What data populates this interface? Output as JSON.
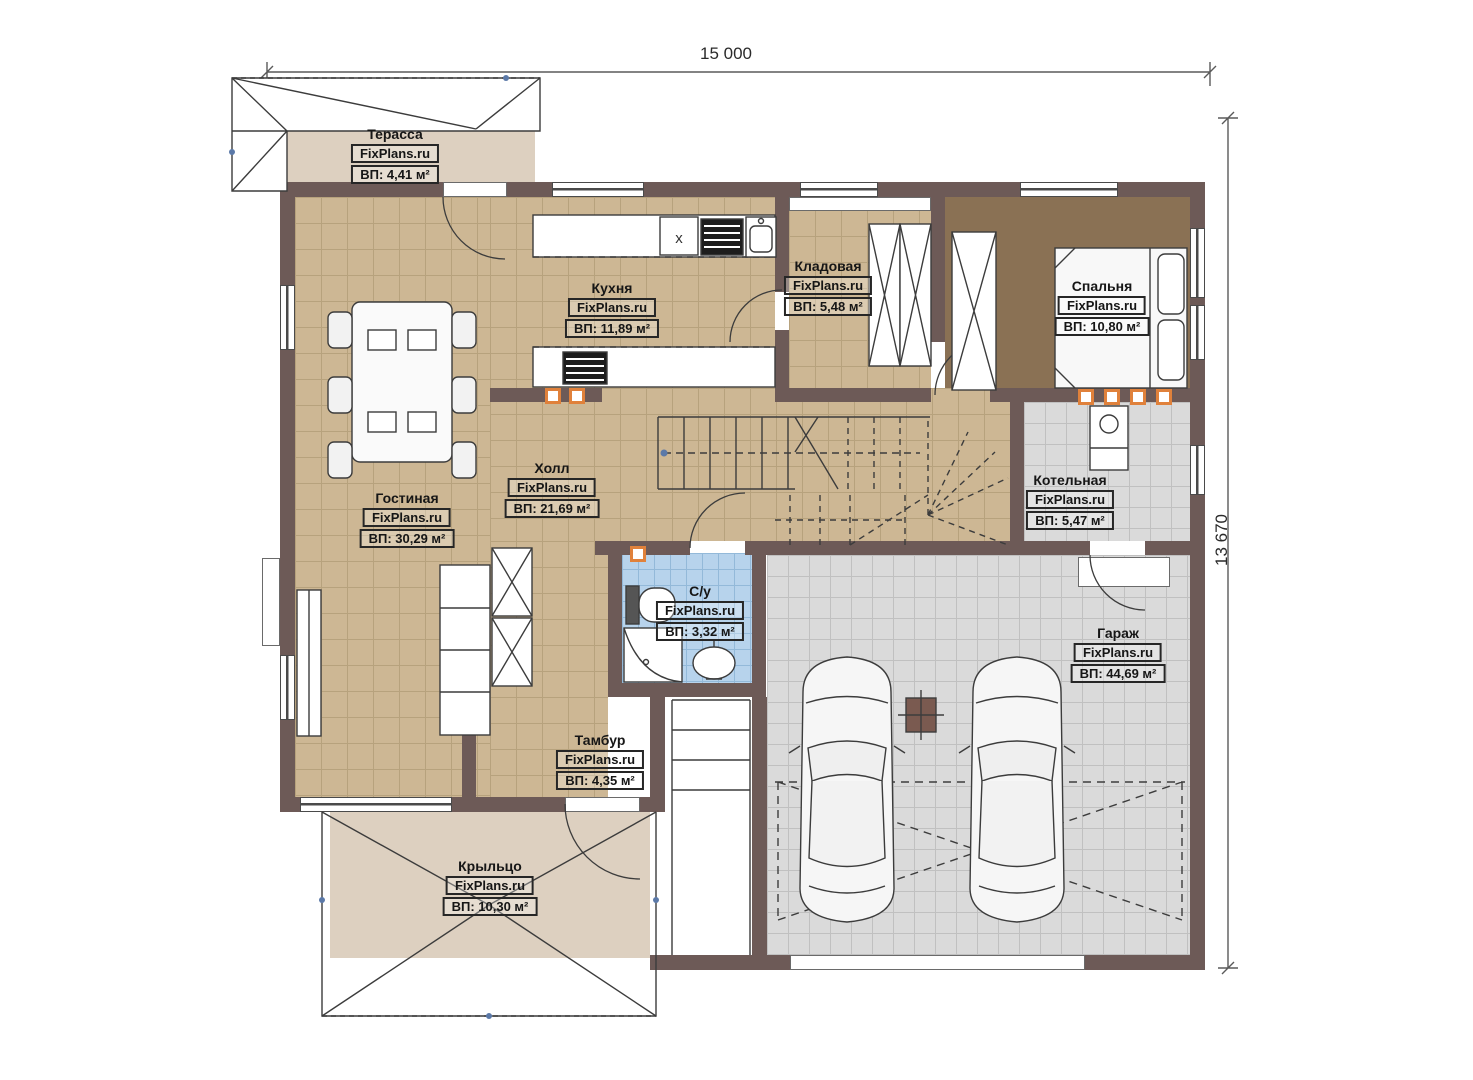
{
  "brand": "FixPlans.ru",
  "dimensions": {
    "width": "15 000",
    "height": "13 670"
  },
  "kitchen_appliance_label": "x",
  "rooms": {
    "terrace": {
      "name": "Терасса",
      "brand": "FixPlans.ru",
      "area": "ВП: 4,41 м²"
    },
    "kitchen": {
      "name": "Кухня",
      "brand": "FixPlans.ru",
      "area": "ВП: 11,89 м²"
    },
    "storage": {
      "name": "Кладовая",
      "brand": "FixPlans.ru",
      "area": "ВП: 5,48 м²"
    },
    "bedroom": {
      "name": "Спальня",
      "brand": "FixPlans.ru",
      "area": "ВП: 10,80 м²"
    },
    "hall": {
      "name": "Холл",
      "brand": "FixPlans.ru",
      "area": "ВП: 21,69 м²"
    },
    "living_room": {
      "name": "Гостиная",
      "brand": "FixPlans.ru",
      "area": "ВП: 30,29 м²"
    },
    "boiler_room": {
      "name": "Котельная",
      "brand": "FixPlans.ru",
      "area": "ВП: 5,47 м²"
    },
    "bathroom": {
      "name": "С/у",
      "brand": "FixPlans.ru",
      "area": "ВП: 3,32 м²"
    },
    "garage": {
      "name": "Гараж",
      "brand": "FixPlans.ru",
      "area": "ВП: 44,69 м²"
    },
    "vestibule": {
      "name": "Тамбур",
      "brand": "FixPlans.ru",
      "area": "ВП: 4,35 м²"
    },
    "porch": {
      "name": "Крыльцо",
      "brand": "FixPlans.ru",
      "area": "ВП: 10,30 м²"
    }
  },
  "colors": {
    "wall": "#6d5a57",
    "floor_tan": "#cdb794",
    "floor_gray": "#dadada",
    "floor_blue": "#b7d3ec",
    "floor_brown": "#8a7154",
    "floor_beige": "#ddd0c0",
    "radiator": "#e0813b"
  }
}
